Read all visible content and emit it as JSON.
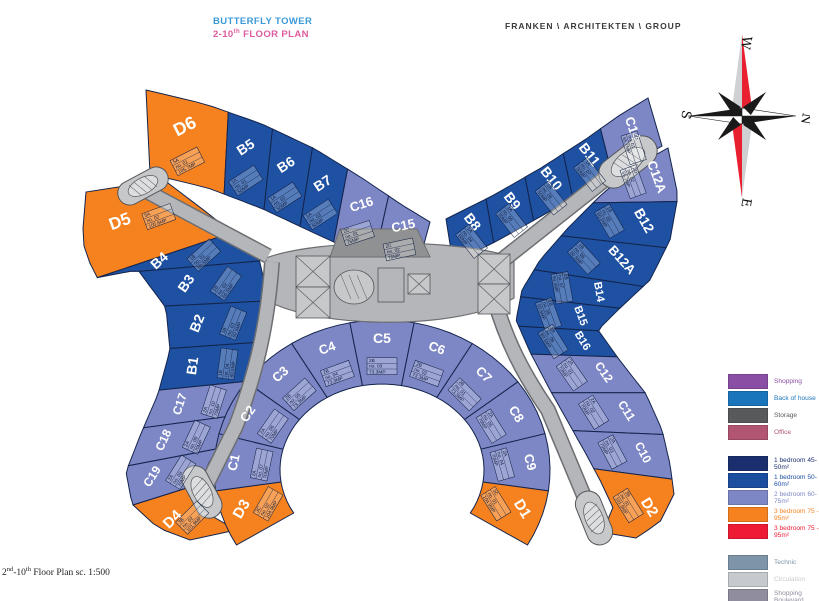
{
  "header": {
    "title_line1": "BUTTERFLY TOWER",
    "title_line2_prefix": "2-10",
    "title_line2_sup": "th",
    "title_line2_rest": "  FLOOR PLAN",
    "firm": "FRANKEN \\ ARCHITEKTEN \\ GROUP"
  },
  "footer": {
    "p1": "2",
    "s1": "nd",
    "p2": "-10",
    "s2": "th",
    "p3": " Floor Plan sc. 1:500"
  },
  "compass": {
    "top": "W",
    "right": "N",
    "bottom": "E",
    "left": "S"
  },
  "colors": {
    "unit_blue": "#1e51a2",
    "unit_peri": "#7d87c6",
    "unit_orange": "#f5821f",
    "road_gray": "#b4b6b9",
    "road_edge": "#6d6e71",
    "core_gray": "#c6c8ca",
    "technic_gray": "#8f9193",
    "wedge_stroke": "#14244c",
    "tag_text": "#0e1c3d",
    "name_text": "#ffffff",
    "compass_red": "#e8202f",
    "compass_gray": "#cfd0d2"
  },
  "legend": {
    "groups": [
      {
        "name": "uses",
        "items": [
          {
            "label": "Shopping",
            "color": "#8a4ea5"
          },
          {
            "label": "Back of house",
            "color": "#1b75bb"
          },
          {
            "label": "Storage",
            "color": "#58595b"
          },
          {
            "label": "Office",
            "color": "#b15573"
          }
        ]
      },
      {
        "name": "residential",
        "items": [
          {
            "label": "1 bedroom 45-50m²",
            "color": "#1b2f6e"
          },
          {
            "label": "1 bedroom 50-60m²",
            "color": "#1c4ea0"
          },
          {
            "label": "2 bedroom 60-75m²",
            "color": "#7d87c6"
          },
          {
            "label": "3 bedroom 75 - 95m²",
            "color": "#f5821f"
          },
          {
            "label": "3 bedroom 75 - 95m²",
            "color": "#ed1b34"
          }
        ]
      },
      {
        "name": "service",
        "items": [
          {
            "label": "Technic",
            "color": "#7e95a9"
          },
          {
            "label": "Circulation",
            "color": "#c6c9cd"
          },
          {
            "label": "Shopping Boulevard",
            "color": "#908d9e"
          }
        ]
      }
    ]
  },
  "plan": {
    "bands": {
      "top_left_wing": {
        "units": [
          {
            "name": "D6",
            "color": "orange",
            "tag": [
              "5A",
              "no. 01",
              "105.7MP"
            ]
          },
          {
            "name": "B5",
            "color": "blue",
            "tag": [
              "1A",
              "no. 01",
              "50MP"
            ]
          },
          {
            "name": "B6",
            "color": "blue",
            "tag": [
              "1A",
              "no. 02",
              "50MP"
            ]
          },
          {
            "name": "B7",
            "color": "blue",
            "tag": [
              "1A",
              "no. 03",
              "50MP"
            ]
          },
          {
            "name": "C16",
            "color": "peri",
            "tag": [
              "2C",
              "no. 01",
              "76MP"
            ]
          },
          {
            "name": "C15",
            "color": "peri",
            "tag": [
              "2C",
              "no. 02",
              "76MP"
            ]
          }
        ]
      },
      "top_right_wing": {
        "units": [
          {
            "name": "B8",
            "color": "blue",
            "tag": [
              "1A",
              "no. 04",
              "50MP"
            ]
          },
          {
            "name": "B9",
            "color": "blue",
            "tag": [
              "1A",
              "no. 05",
              "50MP"
            ]
          },
          {
            "name": "B10",
            "color": "blue",
            "tag": [
              "1A",
              "no. 06",
              "50MP"
            ]
          },
          {
            "name": "B11",
            "color": "blue",
            "tag": [
              "1A",
              "no. 07",
              "50MP"
            ]
          },
          {
            "name": "C14",
            "color": "peri",
            "tag": [
              "2D",
              "no. 01",
              "65.7MP"
            ]
          }
        ]
      },
      "left_arc": {
        "units": [
          {
            "name": "D5",
            "color": "orange",
            "tag": [
              "5A",
              "no. 02",
              "105.6MP"
            ]
          },
          {
            "name": "B4",
            "color": "blue",
            "tag": [
              "1B",
              "no. 01",
              "60.5MP"
            ]
          },
          {
            "name": "B3",
            "color": "blue",
            "tag": [
              "1B",
              "no. 02",
              "60.5MP"
            ]
          },
          {
            "name": "B2",
            "color": "blue",
            "tag": [
              "1B",
              "no. 03",
              "60.5MP"
            ]
          },
          {
            "name": "B1",
            "color": "blue",
            "tag": [
              "1B",
              "no. 04",
              "60.5MP"
            ]
          },
          {
            "name": "C17",
            "color": "peri",
            "tag": [
              "2A",
              "no. 10",
              "70MP"
            ]
          },
          {
            "name": "C18",
            "color": "peri",
            "tag": [
              "2A",
              "no. 09",
              "70MP"
            ]
          },
          {
            "name": "C19",
            "color": "peri",
            "tag": [
              "2A",
              "no. 08",
              "70MP"
            ]
          },
          {
            "name": "D4",
            "color": "orange",
            "tag": [
              "3B",
              "no. 02",
              "101.9MP"
            ]
          }
        ]
      },
      "right_arc": {
        "units": [
          {
            "name": "C12A",
            "color": "peri",
            "tag": [
              "2D",
              "no. 02",
              "65.7MP"
            ]
          },
          {
            "name": "B12",
            "color": "blue",
            "tag": [
              "1B",
              "no. 05",
              "60.5MP"
            ]
          },
          {
            "name": "B12A",
            "color": "blue",
            "tag": [
              "1B",
              "no. 06",
              "60.5MP"
            ]
          },
          {
            "name": "B14",
            "color": "blue",
            "tag": [
              "1B",
              "no. 07",
              "60.5MP"
            ]
          },
          {
            "name": "B15",
            "color": "blue",
            "tag": [
              "1B",
              "no. 08",
              "60.5MP"
            ]
          },
          {
            "name": "B16",
            "color": "blue",
            "tag": [
              "1B",
              "no. 09",
              "60.5MP"
            ]
          },
          {
            "name": "C12",
            "color": "peri",
            "tag": [
              "2A",
              "no. 01",
              "70MP"
            ]
          },
          {
            "name": "C11",
            "color": "peri",
            "tag": [
              "2A",
              "no. 02",
              "70MP"
            ]
          },
          {
            "name": "C10",
            "color": "peri",
            "tag": [
              "2A",
              "no. 03",
              "70MP"
            ]
          },
          {
            "name": "D2",
            "color": "orange",
            "tag": [
              "3B",
              "no. 01",
              "101.9MP"
            ]
          }
        ]
      },
      "horseshoe": {
        "units": [
          {
            "name": "D3",
            "color": "orange",
            "tag": [
              "3C",
              "no. 02",
              "104.9MP"
            ]
          },
          {
            "name": "C1",
            "color": "peri",
            "tag": [
              "2A",
              "no. 07",
              "70MP"
            ]
          },
          {
            "name": "C2",
            "color": "peri",
            "tag": [
              "2A",
              "no. 06",
              "70MP"
            ]
          },
          {
            "name": "C3",
            "color": "peri",
            "tag": [
              "2B",
              "no. 05",
              "73.3MP"
            ]
          },
          {
            "name": "C4",
            "color": "peri",
            "tag": [
              "2B",
              "no. 04",
              "73.3MP"
            ]
          },
          {
            "name": "C5",
            "color": "peri",
            "tag": [
              "2B",
              "no. 03",
              "73.3MP"
            ]
          },
          {
            "name": "C6",
            "color": "peri",
            "tag": [
              "2B",
              "no. 02",
              "73.3MP"
            ]
          },
          {
            "name": "C7",
            "color": "peri",
            "tag": [
              "2B",
              "no. 01",
              "73.3MP"
            ]
          },
          {
            "name": "C8",
            "color": "peri",
            "tag": [
              "2A",
              "no. 05",
              "70MP"
            ]
          },
          {
            "name": "C9",
            "color": "peri",
            "tag": [
              "2A",
              "no. 04",
              "70MP"
            ]
          },
          {
            "name": "D1",
            "color": "orange",
            "tag": [
              "3C",
              "no. 01",
              "104.9MP"
            ]
          }
        ]
      }
    }
  }
}
